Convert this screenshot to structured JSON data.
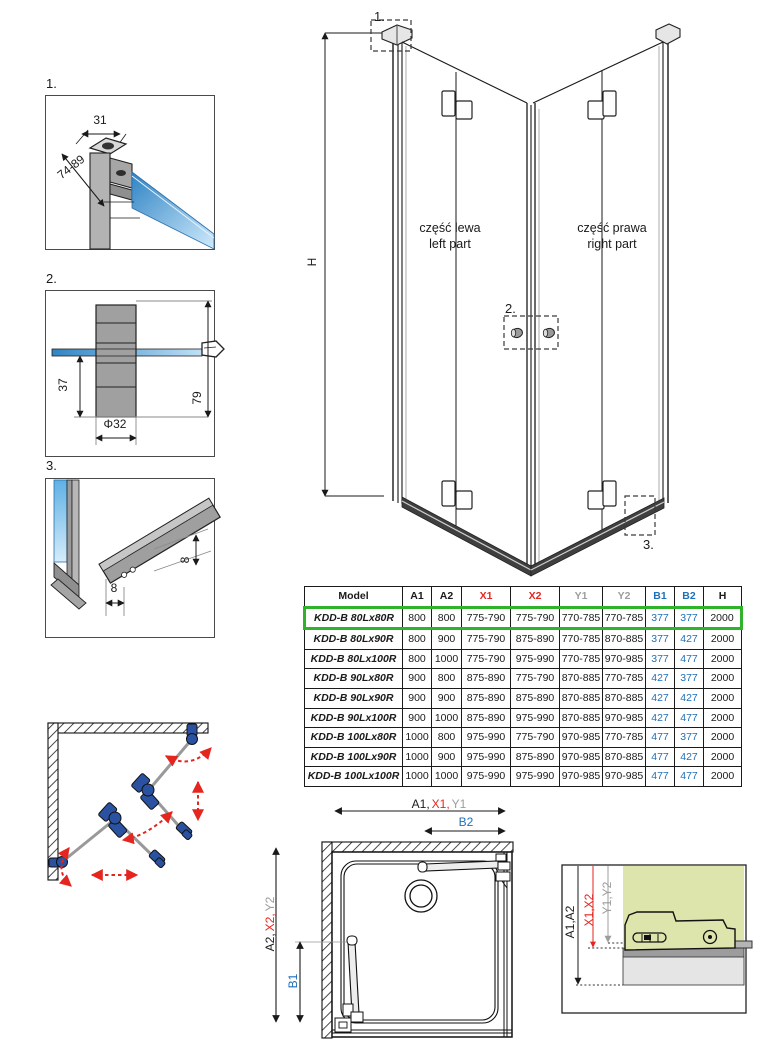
{
  "colors": {
    "accent_red": "#e5261f",
    "accent_gray": "#9d9d9c",
    "accent_blue": "#1f70b8",
    "highlight_green": "#2fb32b",
    "glass_blue": "#4aa0dc",
    "profile_gray": "#a9a9a9",
    "wall_green": "#dde4ac",
    "hinge_blue": "#2a52a0"
  },
  "details": {
    "d1": {
      "label": "1.",
      "dim_width": "31",
      "dim_range": "74-89"
    },
    "d2": {
      "label": "2.",
      "dim_inset": "37",
      "dim_diameter": "Φ32",
      "dim_height": "79"
    },
    "d3": {
      "label": "3.",
      "dim_w": "8",
      "dim_h": "8"
    }
  },
  "main": {
    "dim_height": "H",
    "callout_1": "1.",
    "callout_2": "2.",
    "callout_3": "3.",
    "left_line1": "część lewa",
    "left_line2": "left part",
    "right_line1": "część prawa",
    "right_line2": "right part"
  },
  "table": {
    "columns": [
      {
        "label": "Model",
        "color": "#1a1a1a"
      },
      {
        "label": "A1",
        "color": "#1a1a1a"
      },
      {
        "label": "A2",
        "color": "#1a1a1a"
      },
      {
        "label": "X1",
        "color": "#e5261f"
      },
      {
        "label": "X2",
        "color": "#e5261f"
      },
      {
        "label": "Y1",
        "color": "#9d9d9c"
      },
      {
        "label": "Y2",
        "color": "#9d9d9c"
      },
      {
        "label": "B1",
        "color": "#1f70b8"
      },
      {
        "label": "B2",
        "color": "#1f70b8"
      },
      {
        "label": "H",
        "color": "#1a1a1a"
      }
    ],
    "value_colors": [
      "#1a1a1a",
      "#1a1a1a",
      "#1a1a1a",
      "#1a1a1a",
      "#1a1a1a",
      "#1a1a1a",
      "#1a1a1a",
      "#1f70b8",
      "#1f70b8",
      "#1a1a1a"
    ],
    "highlight_row": 0,
    "rows": [
      [
        "KDD-B 80Lx80R",
        "800",
        "800",
        "775-790",
        "775-790",
        "770-785",
        "770-785",
        "377",
        "377",
        "2000"
      ],
      [
        "KDD-B 80Lx90R",
        "800",
        "900",
        "775-790",
        "875-890",
        "770-785",
        "870-885",
        "377",
        "427",
        "2000"
      ],
      [
        "KDD-B 80Lx100R",
        "800",
        "1000",
        "775-790",
        "975-990",
        "770-785",
        "970-985",
        "377",
        "477",
        "2000"
      ],
      [
        "KDD-B 90Lx80R",
        "900",
        "800",
        "875-890",
        "775-790",
        "870-885",
        "770-785",
        "427",
        "377",
        "2000"
      ],
      [
        "KDD-B 90Lx90R",
        "900",
        "900",
        "875-890",
        "875-890",
        "870-885",
        "870-885",
        "427",
        "427",
        "2000"
      ],
      [
        "KDD-B 90Lx100R",
        "900",
        "1000",
        "875-890",
        "975-990",
        "870-885",
        "970-985",
        "427",
        "477",
        "2000"
      ],
      [
        "KDD-B 100Lx80R",
        "1000",
        "800",
        "975-990",
        "775-790",
        "970-985",
        "770-785",
        "477",
        "377",
        "2000"
      ],
      [
        "KDD-B 100Lx90R",
        "1000",
        "900",
        "975-990",
        "875-890",
        "970-985",
        "870-885",
        "477",
        "427",
        "2000"
      ],
      [
        "KDD-B 100Lx100R",
        "1000",
        "1000",
        "975-990",
        "975-990",
        "970-985",
        "970-985",
        "477",
        "477",
        "2000"
      ]
    ]
  },
  "top_view": {
    "a1": "A1,",
    "x1": "X1,",
    "y1": "Y1",
    "b2": "B2",
    "a2": "A2,",
    "x2": "X2,",
    "y2": "Y2",
    "b1": "B1"
  },
  "section": {
    "aa": "A1,A2",
    "xx": "X1,X2",
    "yy": "Y1,Y2"
  }
}
